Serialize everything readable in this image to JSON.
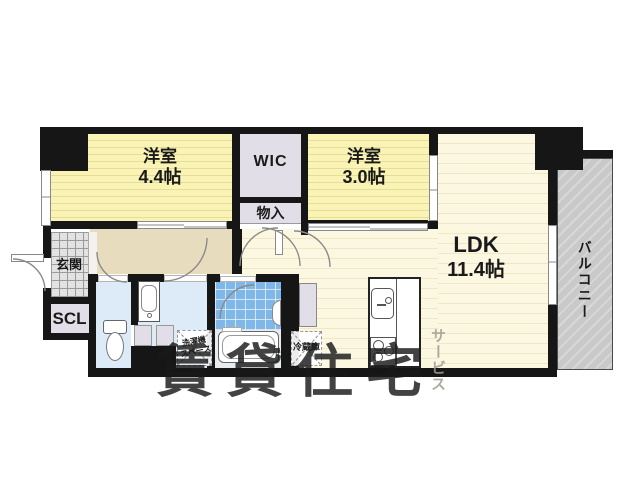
{
  "rooms": {
    "bedroom1": {
      "label": "洋室",
      "size": "4.4帖"
    },
    "bedroom2": {
      "label": "洋室",
      "size": "3.0帖"
    },
    "ldk": {
      "label": "LDK",
      "size": "11.4帖"
    },
    "wic": {
      "label": "WIC"
    },
    "closet": {
      "label": "物入"
    },
    "entrance": {
      "label": "玄関"
    },
    "shoe_closet": {
      "label": "SCL"
    },
    "balcony": {
      "label": "バルコニー"
    }
  },
  "fixtures": {
    "refrigerator": {
      "label": "冷蔵庫"
    },
    "washer": {
      "line1": "洗濯機",
      "line2": "スペース"
    }
  },
  "watermark": {
    "main": "賃貸住宅",
    "sub": "サービス"
  },
  "colors": {
    "wall": "#161616",
    "tatami": "#f9f3b5",
    "ldk_floor": "#fbf7e1",
    "closet_fill": "#e2dee8",
    "hallway": "#e7dcbe",
    "water_rooms": "#dcebf7",
    "bath_tile": "#7fb8e8",
    "balcony": "#cccccc",
    "watermark_main": "rgba(25,25,25,0.82)",
    "watermark_sub": "rgba(160,153,144,0.85)"
  }
}
